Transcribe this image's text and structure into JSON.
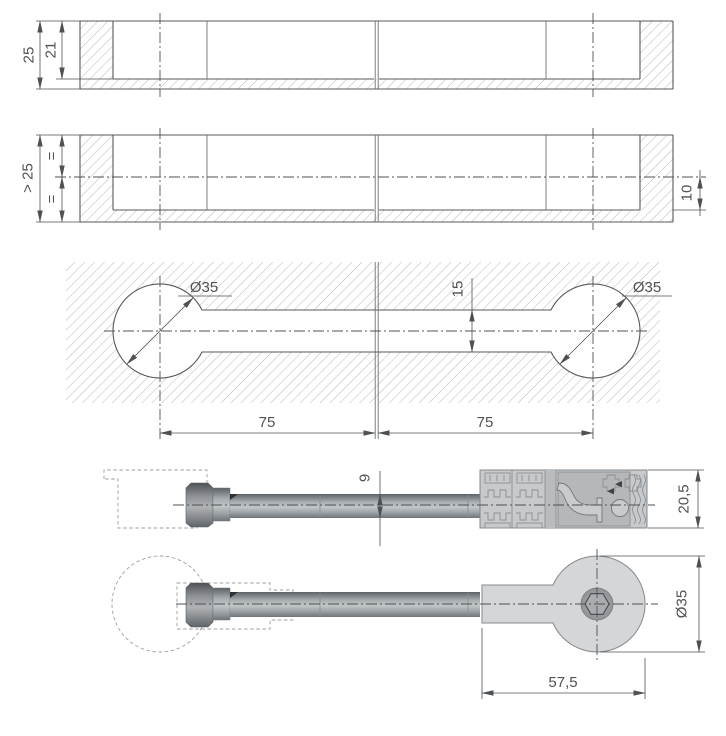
{
  "drawing": {
    "kind": "furniture-connector-drilling-and-fitting-drawing",
    "colors": {
      "background": "#ffffff",
      "line": "#55595c",
      "dimension_line": "#4d5154",
      "hatch": "#b0b0b0",
      "phantom": "#9b9ea1",
      "metal_dark": "#5d6266",
      "metal_light": "#c3c6c8",
      "housing_gray": "#c6c9cb",
      "disc_gray": "#d4d6d7"
    },
    "views": [
      {
        "name": "panel-cross-section-standard",
        "dimensions": [
          "25",
          "21"
        ]
      },
      {
        "name": "panel-cross-section-thick",
        "dimensions": [
          "> 25",
          "=",
          "=",
          "10"
        ]
      },
      {
        "name": "drilling-plan",
        "dimensions": [
          "Ø35",
          "Ø35",
          "15",
          "75",
          "75"
        ]
      },
      {
        "name": "fitting-side-view",
        "dimensions": [
          "9",
          "20,5"
        ]
      },
      {
        "name": "fitting-top-view",
        "dimensions": [
          "Ø35",
          "57,5"
        ]
      }
    ],
    "labels": {
      "dim_25": "25",
      "dim_21": "21",
      "dim_gt25": "> 25",
      "dim_eq_top": "=",
      "dim_eq_bottom": "=",
      "dim_10": "10",
      "dim_d35_left": "Ø35",
      "dim_d35_right": "Ø35",
      "dim_15": "15",
      "dim_75_left": "75",
      "dim_75_right": "75",
      "dim_9": "9",
      "dim_20_5": "20,5",
      "dim_d35_cam": "Ø35",
      "dim_57_5": "57,5"
    }
  }
}
